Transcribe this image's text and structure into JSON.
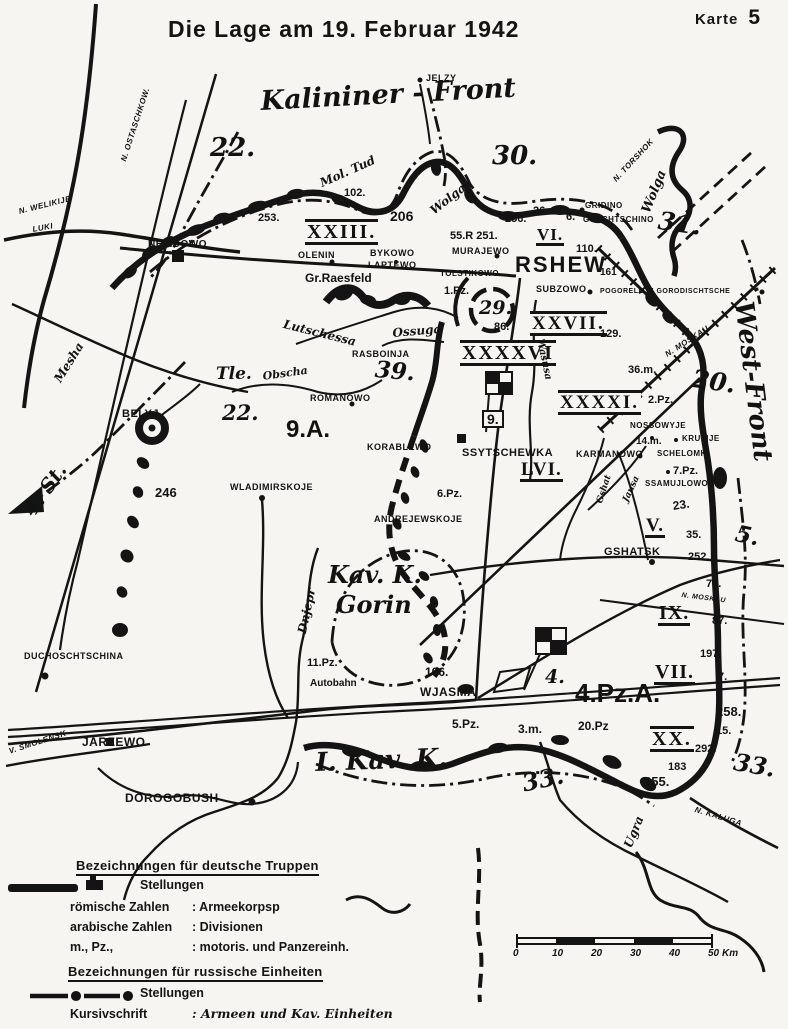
{
  "page": {
    "karte_label": "Karte",
    "karte_number": "5",
    "title": "Die Lage am 19. Februar 1942"
  },
  "colors": {
    "ink": "#141414",
    "paper": "#f6f5f1"
  },
  "icons": {
    "german_position_symbol": "thick-black-bar",
    "german_block_symbol": "solid-position-block",
    "russian_position_symbol": "dash-dot-line",
    "hq_flag_symbol": "checkered-flag"
  },
  "legend": {
    "german": {
      "title": "Bezeichnungen für deutsche Truppen",
      "stellungen": "Stellungen",
      "rows": [
        {
          "label": "römische Zahlen",
          "value": ": Armeekorpsp"
        },
        {
          "label": "arabische Zahlen",
          "value": ": Divisionen"
        },
        {
          "label": "m., Pz.,",
          "value": ": motoris. und Panzereinh."
        }
      ]
    },
    "russian": {
      "title": "Bezeichnungen für russische Einheiten",
      "stellungen": "Stellungen",
      "rows": [
        {
          "label": "Kursivschrift",
          "value": ": Armeen und Kav. Einheiten"
        }
      ]
    }
  },
  "scale_bar": {
    "ticks": [
      "0",
      "10",
      "20",
      "30",
      "40",
      "50"
    ],
    "unit": "Km"
  },
  "map": {
    "fronts": {
      "kalinin": "Kalininer - Front",
      "west": "West-Front"
    },
    "labels": [
      {
        "t": "Kalininer - Front",
        "x": 260,
        "y": 88,
        "cls": "front",
        "fs": 27,
        "rot": -3
      },
      {
        "t": "West-Front",
        "x": 756,
        "y": 300,
        "cls": "front",
        "fs": 26,
        "rot": 83
      },
      {
        "t": "n. OSTASCHKOW.",
        "x": 120,
        "y": 160,
        "cls": "dir",
        "rot": -72
      },
      {
        "t": "n. WELIKIJE",
        "x": 18,
        "y": 208,
        "cls": "dir",
        "rot": -14
      },
      {
        "t": "LUKI",
        "x": 32,
        "y": 226,
        "cls": "dir",
        "rot": -10
      },
      {
        "t": "JELZY",
        "x": 426,
        "y": 74,
        "cls": "city",
        "fs": 9
      },
      {
        "t": "22.",
        "x": 210,
        "y": 135,
        "cls": "army-ru",
        "fs": 26
      },
      {
        "t": "30.",
        "x": 492,
        "y": 143,
        "cls": "army-ru",
        "fs": 26
      },
      {
        "t": "31.",
        "x": 660,
        "y": 208,
        "cls": "army-ru",
        "fs": 25,
        "rot": 8
      },
      {
        "t": "n. TORSHOK",
        "x": 612,
        "y": 178,
        "cls": "dir",
        "rot": -47
      },
      {
        "t": "Wolga",
        "x": 640,
        "y": 210,
        "cls": "river",
        "fs": 13,
        "rot": -68
      },
      {
        "t": "Wolga",
        "x": 428,
        "y": 207,
        "cls": "river",
        "fs": 12,
        "rot": -38
      },
      {
        "t": "Mol. Tud",
        "x": 318,
        "y": 178,
        "cls": "river",
        "fs": 12,
        "rot": -24
      },
      {
        "t": "102.",
        "x": 344,
        "y": 188,
        "cls": "div"
      },
      {
        "t": "253.",
        "x": 258,
        "y": 213,
        "cls": "div"
      },
      {
        "t": "206",
        "x": 390,
        "y": 209,
        "cls": "div",
        "fs": 14
      },
      {
        "t": "XXIII.",
        "x": 305,
        "y": 219,
        "cls": "corps",
        "fs": 20
      },
      {
        "t": "NELIDOWO",
        "x": 148,
        "y": 240,
        "cls": "city"
      },
      {
        "t": "OLENIN",
        "x": 298,
        "y": 251,
        "cls": "city",
        "fs": 9
      },
      {
        "t": "BYKOWO",
        "x": 370,
        "y": 249,
        "cls": "city",
        "fs": 9
      },
      {
        "t": "LAPTEWO",
        "x": 368,
        "y": 261,
        "cls": "city",
        "fs": 9
      },
      {
        "t": "Gr.Raesfeld",
        "x": 305,
        "y": 272,
        "cls": "place"
      },
      {
        "t": "256.",
        "x": 505,
        "y": 214,
        "cls": "div"
      },
      {
        "t": "26.",
        "x": 533,
        "y": 206,
        "cls": "div"
      },
      {
        "t": "6.",
        "x": 566,
        "y": 212,
        "cls": "div"
      },
      {
        "t": "GRIDINO",
        "x": 585,
        "y": 202,
        "cls": "city",
        "fs": 8
      },
      {
        "t": "GUSCHTSCHINO",
        "x": 583,
        "y": 216,
        "cls": "city",
        "fs": 8
      },
      {
        "t": "55.R 251.",
        "x": 450,
        "y": 231,
        "cls": "div"
      },
      {
        "t": "VI.",
        "x": 536,
        "y": 226,
        "cls": "corps-u",
        "fs": 17
      },
      {
        "t": "110.",
        "x": 576,
        "y": 244,
        "cls": "div"
      },
      {
        "t": "MURAJEWO",
        "x": 452,
        "y": 247,
        "cls": "city",
        "fs": 9
      },
      {
        "t": "TOLSTIKOWO",
        "x": 440,
        "y": 270,
        "cls": "city",
        "fs": 8
      },
      {
        "t": "RSHEW",
        "x": 515,
        "y": 254,
        "cls": "city-lg"
      },
      {
        "t": "161",
        "x": 600,
        "y": 268,
        "cls": "div",
        "fs": 10
      },
      {
        "t": "SUBZOWO",
        "x": 536,
        "y": 285,
        "cls": "city",
        "fs": 9
      },
      {
        "t": "POGORELOJE GORODISCHTSCHE",
        "x": 600,
        "y": 288,
        "cls": "city",
        "fs": 7
      },
      {
        "t": "1.Pz.",
        "x": 444,
        "y": 286,
        "cls": "div"
      },
      {
        "t": "29.",
        "x": 479,
        "y": 299,
        "cls": "army-ru",
        "fs": 19
      },
      {
        "t": "86.",
        "x": 494,
        "y": 322,
        "cls": "div"
      },
      {
        "t": "XXVII.",
        "x": 530,
        "y": 311,
        "cls": "corps",
        "fs": 19
      },
      {
        "t": "129.",
        "x": 600,
        "y": 329,
        "cls": "div"
      },
      {
        "t": "XXXXVI",
        "x": 460,
        "y": 340,
        "cls": "corps",
        "fs": 20
      },
      {
        "t": "36.m.",
        "x": 628,
        "y": 365,
        "cls": "div"
      },
      {
        "t": "2.Pz.",
        "x": 648,
        "y": 395,
        "cls": "div"
      },
      {
        "t": "XXXXI.",
        "x": 558,
        "y": 390,
        "cls": "corps",
        "fs": 19
      },
      {
        "t": "20.",
        "x": 694,
        "y": 366,
        "cls": "army-ru",
        "fs": 25,
        "rot": 8
      },
      {
        "t": "n. MOSKAU",
        "x": 664,
        "y": 352,
        "cls": "dir",
        "rot": -33
      },
      {
        "t": "n. MOSKAU",
        "x": 682,
        "y": 592,
        "cls": "dir",
        "fs": 7,
        "rot": 7
      },
      {
        "t": "RASBOINJA",
        "x": 352,
        "y": 350,
        "cls": "city",
        "fs": 9
      },
      {
        "t": "39.",
        "x": 376,
        "y": 358,
        "cls": "army-ru",
        "fs": 23,
        "rot": 5
      },
      {
        "t": "Ossuga",
        "x": 392,
        "y": 327,
        "cls": "river",
        "fs": 12,
        "rot": -5
      },
      {
        "t": "Lutschessa",
        "x": 285,
        "y": 318,
        "cls": "river",
        "fs": 12,
        "rot": 14
      },
      {
        "t": "Mesha",
        "x": 52,
        "y": 378,
        "cls": "river",
        "fs": 12,
        "rot": -58
      },
      {
        "t": "Obscha",
        "x": 262,
        "y": 371,
        "cls": "river",
        "fs": 11,
        "rot": -8
      },
      {
        "t": "ROMANOWO",
        "x": 310,
        "y": 394,
        "cls": "city",
        "fs": 9
      },
      {
        "t": "Tle.",
        "x": 216,
        "y": 366,
        "cls": "army-ru",
        "fs": 17
      },
      {
        "t": "22.",
        "x": 222,
        "y": 402,
        "cls": "army-ru",
        "fs": 21
      },
      {
        "t": "BELYJ",
        "x": 122,
        "y": 409,
        "cls": "city",
        "fs": 11
      },
      {
        "t": "9.A.",
        "x": 286,
        "y": 418,
        "cls": "army-de",
        "fs": 24
      },
      {
        "t": "4. St.",
        "x": 20,
        "y": 508,
        "cls": "army-ru",
        "fs": 20,
        "rot": -55
      },
      {
        "t": "246",
        "x": 155,
        "y": 486,
        "cls": "div",
        "fs": 13
      },
      {
        "t": "WLADIMIRSKOJE",
        "x": 230,
        "y": 483,
        "cls": "city",
        "fs": 9
      },
      {
        "t": "KORABLEWO",
        "x": 367,
        "y": 443,
        "cls": "city",
        "fs": 9
      },
      {
        "t": "SSYTSCHEWKA",
        "x": 462,
        "y": 448,
        "cls": "city",
        "fs": 11
      },
      {
        "t": "KARMANOWO",
        "x": 576,
        "y": 450,
        "cls": "city",
        "fs": 9
      },
      {
        "t": "NOSSOWYJE",
        "x": 630,
        "y": 422,
        "cls": "city",
        "fs": 8
      },
      {
        "t": "14.m.",
        "x": 636,
        "y": 437,
        "cls": "div",
        "fs": 10
      },
      {
        "t": "KRUTIJE",
        "x": 682,
        "y": 435,
        "cls": "city",
        "fs": 8
      },
      {
        "t": "SCHELOMKI",
        "x": 657,
        "y": 450,
        "cls": "city",
        "fs": 8
      },
      {
        "t": "7.Pz.",
        "x": 673,
        "y": 466,
        "cls": "div"
      },
      {
        "t": "SSAMUJLOWO",
        "x": 645,
        "y": 480,
        "cls": "city",
        "fs": 8
      },
      {
        "t": "LVI.",
        "x": 520,
        "y": 460,
        "cls": "corps-u",
        "fs": 19
      },
      {
        "t": "6.Pz.",
        "x": 437,
        "y": 489,
        "cls": "div"
      },
      {
        "t": "ANDREJEWSKOJE",
        "x": 374,
        "y": 515,
        "cls": "city",
        "fs": 9
      },
      {
        "t": "Gshat",
        "x": 596,
        "y": 502,
        "cls": "river",
        "fs": 9,
        "rot": -72
      },
      {
        "t": "Jausa",
        "x": 622,
        "y": 500,
        "cls": "river",
        "fs": 9,
        "rot": -65
      },
      {
        "t": "23.",
        "x": 672,
        "y": 500,
        "cls": "div",
        "fs": 12,
        "rot": -8
      },
      {
        "t": "V.",
        "x": 645,
        "y": 516,
        "cls": "corps-u",
        "fs": 19
      },
      {
        "t": "35.",
        "x": 686,
        "y": 530,
        "cls": "div"
      },
      {
        "t": "252.",
        "x": 688,
        "y": 552,
        "cls": "div"
      },
      {
        "t": "GSHATSK",
        "x": 604,
        "y": 547,
        "cls": "city",
        "fs": 11
      },
      {
        "t": "78.",
        "x": 706,
        "y": 579,
        "cls": "div"
      },
      {
        "t": "5.",
        "x": 738,
        "y": 522,
        "cls": "army-ru",
        "fs": 23,
        "rot": 12
      },
      {
        "t": "IX.",
        "x": 658,
        "y": 603,
        "cls": "corps-u",
        "fs": 20
      },
      {
        "t": "87.",
        "x": 712,
        "y": 616,
        "cls": "div"
      },
      {
        "t": "197.",
        "x": 700,
        "y": 649,
        "cls": "div"
      },
      {
        "t": "VII.",
        "x": 654,
        "y": 662,
        "cls": "corps-u",
        "fs": 20
      },
      {
        "t": "7.",
        "x": 718,
        "y": 672,
        "cls": "div"
      },
      {
        "t": "258.",
        "x": 716,
        "y": 705,
        "cls": "div",
        "fs": 13
      },
      {
        "t": "15.",
        "x": 716,
        "y": 726,
        "cls": "div"
      },
      {
        "t": "XX.",
        "x": 650,
        "y": 726,
        "cls": "corps",
        "fs": 20
      },
      {
        "t": "292.",
        "x": 695,
        "y": 744,
        "cls": "div"
      },
      {
        "t": "183",
        "x": 668,
        "y": 762,
        "cls": "div"
      },
      {
        "t": "255.",
        "x": 644,
        "y": 775,
        "cls": "div",
        "fs": 13
      },
      {
        "t": "33.",
        "x": 736,
        "y": 750,
        "cls": "army-ru",
        "fs": 24,
        "rot": 10
      },
      {
        "t": "33.",
        "x": 520,
        "y": 772,
        "cls": "army-ru",
        "fs": 24,
        "rot": -12
      },
      {
        "t": "n. KALUGA",
        "x": 696,
        "y": 806,
        "cls": "dir",
        "rot": 17
      },
      {
        "t": "Kav. K.",
        "x": 328,
        "y": 563,
        "cls": "army-ru",
        "fs": 24
      },
      {
        "t": "Gorin",
        "x": 336,
        "y": 593,
        "cls": "army-ru",
        "fs": 24
      },
      {
        "t": "Dnjepr",
        "x": 296,
        "y": 632,
        "cls": "river",
        "fs": 12,
        "rot": -78
      },
      {
        "t": "Wasusa",
        "x": 544,
        "y": 338,
        "cls": "river",
        "fs": 10,
        "rot": 78
      },
      {
        "t": "11.Pz.",
        "x": 307,
        "y": 658,
        "cls": "div"
      },
      {
        "t": "Autobahn",
        "x": 310,
        "y": 679,
        "cls": "place",
        "fs": 10
      },
      {
        "t": "106.",
        "x": 425,
        "y": 666,
        "cls": "div",
        "fs": 12
      },
      {
        "t": "WJASMA",
        "x": 420,
        "y": 686,
        "cls": "city",
        "fs": 12
      },
      {
        "t": "4.",
        "x": 545,
        "y": 668,
        "cls": "army-ru",
        "fs": 19
      },
      {
        "t": "4.Pz.A.",
        "x": 575,
        "y": 680,
        "cls": "army-de",
        "fs": 26
      },
      {
        "t": "9.",
        "x": 482,
        "y": 410,
        "cls": "hq"
      },
      {
        "t": "5.Pz.",
        "x": 452,
        "y": 718,
        "cls": "div",
        "fs": 12
      },
      {
        "t": "3.m.",
        "x": 518,
        "y": 723,
        "cls": "div",
        "fs": 12
      },
      {
        "t": "20.Pz",
        "x": 578,
        "y": 720,
        "cls": "div",
        "fs": 12
      },
      {
        "t": "DUCHOSCHTSCHINA",
        "x": 24,
        "y": 652,
        "cls": "city",
        "fs": 9
      },
      {
        "t": "v. SMOLENSK",
        "x": 8,
        "y": 748,
        "cls": "dir",
        "rot": -18
      },
      {
        "t": "JARZEWO",
        "x": 82,
        "y": 736,
        "cls": "city",
        "fs": 12
      },
      {
        "t": "DOROGOBUSH",
        "x": 125,
        "y": 792,
        "cls": "city",
        "fs": 12
      },
      {
        "t": "I. Kav. K.",
        "x": 315,
        "y": 750,
        "cls": "army-ru",
        "fs": 26,
        "rot": -2
      },
      {
        "t": "Ugra",
        "x": 622,
        "y": 845,
        "cls": "river",
        "fs": 12,
        "rot": -68
      }
    ]
  }
}
